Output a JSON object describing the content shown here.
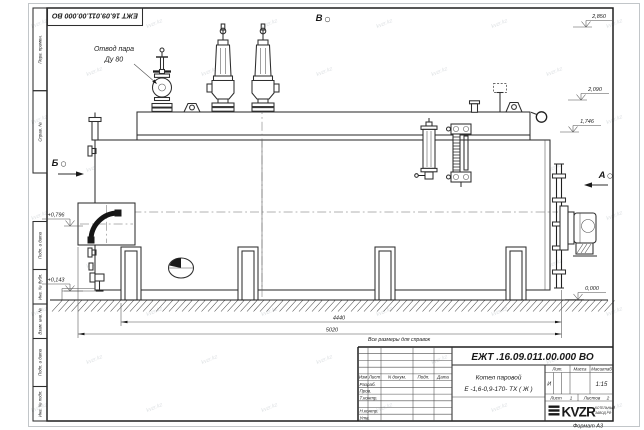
{
  "colors": {
    "line": "#2e2e2e",
    "background": "#ffffff",
    "watermark": "#c2c8cd"
  },
  "frame": {
    "doc_number_top": "ЕЖТ 16.09.011.00.000  ВО",
    "format_label": "Формат А3",
    "margin_labels": [
      "Перв. примен.",
      "Справ. №",
      "Подп. и дата",
      "Инв. № дубл.",
      "Взам. инв. №",
      "Подп. и дата",
      "Инв. № подл."
    ]
  },
  "drawing": {
    "note": "Все размеры для справок",
    "callout_line1": "Отвод пара",
    "callout_line2": "Ду 80",
    "view_b_top": "В",
    "view_b_left": "Б",
    "view_a_right": "А",
    "elevations": {
      "e2850": "2,850",
      "e2090": "2,090",
      "e1746": "1,746",
      "e0000": "0,000",
      "e0796": "+0,796",
      "e0143": "+0,143"
    },
    "dims": {
      "d4440": "4440",
      "d5020": "5020"
    }
  },
  "title_block": {
    "doc_number": "ЕЖТ .16.09.011.00.000  ВО",
    "name_line1": "Котел паровой",
    "name_line2": "Е -1,6-0,9-170- ТХ ( Ж )",
    "rev_header": {
      "izm": "Изм",
      "list": "Лист",
      "ndoc": "N докум.",
      "podp": "Подп.",
      "data": "Дата"
    },
    "roles": {
      "r1": "Разраб.",
      "r2": "Пров.",
      "r3": "Т.контр.",
      "r4": "Н.контр.",
      "r5": "Утв."
    },
    "lit_header": {
      "lit": "Лит.",
      "massa": "Масса",
      "scale": "Масштаб"
    },
    "lit_value": "И",
    "scale_value": "1:15",
    "sheet": {
      "sheet_label": "Лист",
      "sheet_no": "1",
      "sheets_label": "Листов",
      "sheets_no": "2"
    },
    "logo": {
      "text": "KVZR",
      "line1": "КОТЕЛЬНЫЙ",
      "line2": "ЗАВОД РФ"
    }
  },
  "watermark": {
    "text": "kvzr.kz"
  }
}
